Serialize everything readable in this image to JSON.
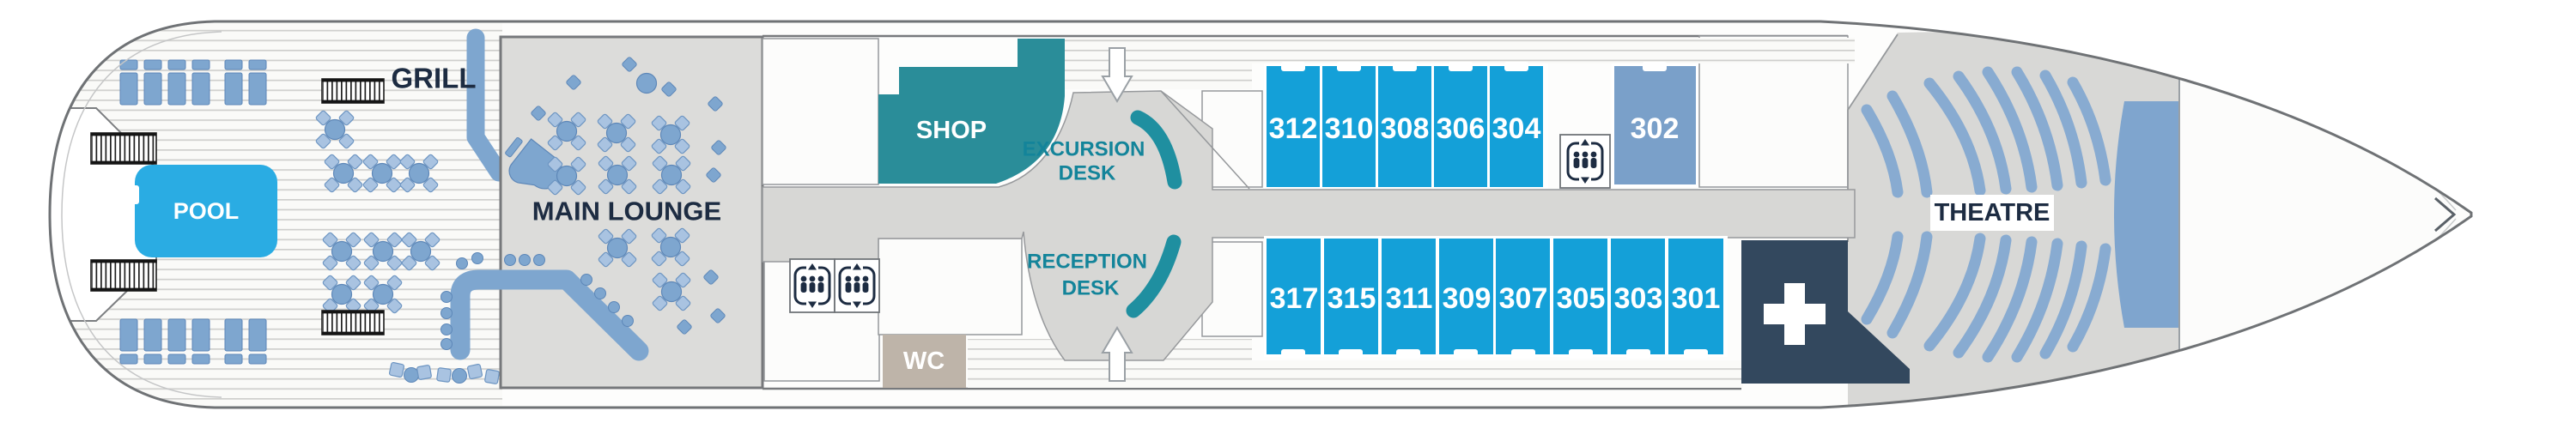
{
  "title": "Cruise ship deck plan",
  "areas": {
    "pool": "POOL",
    "grill": "GRILL",
    "main_lounge": "MAIN LOUNGE",
    "shop": "SHOP",
    "wc": "WC",
    "theatre": "THEATRE",
    "excursion_desk": [
      "EXCURSION",
      "DESK"
    ],
    "reception_desk": [
      "RECEPTION",
      "DESK"
    ]
  },
  "cabins": {
    "port_row": [
      "312",
      "310",
      "308",
      "306",
      "304"
    ],
    "port_special": "302",
    "starboard_row": [
      "317",
      "315",
      "311",
      "309",
      "307",
      "305",
      "303",
      "301"
    ]
  },
  "icons": {
    "elevator": "elevator-icon",
    "medical": "medical-cross-icon",
    "gangway_down": "gangway-arrow-down-icon",
    "gangway_up": "gangway-arrow-up-icon",
    "stairs": "stairs-icon",
    "bow": "bow-chevron-icon"
  },
  "colors": {
    "cabin": "#14a0d8",
    "special_cabin": "#7aa0c9",
    "pool": "#2aace3",
    "shop": "#2a8d99",
    "wc": "#beb4a9",
    "medical": "#33485e",
    "stage": "#7fa5ce",
    "desk": "#1f8fa0",
    "furniture": "#7ea6cf",
    "seats": "#88abd1",
    "navy": "#1d2c42"
  }
}
